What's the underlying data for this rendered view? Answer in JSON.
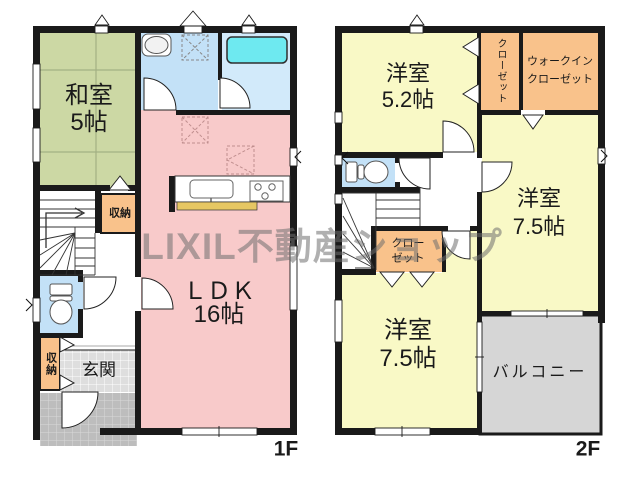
{
  "watermark": "LIXIL不動産ショップ",
  "floor1": {
    "label": "1F",
    "washitsu": {
      "name": "和室",
      "size": "5帖"
    },
    "ldk": {
      "name": "ＬＤＫ",
      "size": "16帖"
    },
    "stair_storage": {
      "name": "収納"
    },
    "entry_storage": {
      "name": "収納"
    },
    "genkan": {
      "name": "玄関"
    }
  },
  "floor2": {
    "label": "2F",
    "bedroom52": {
      "name": "洋室",
      "size": "5.2帖"
    },
    "bedroom75_right": {
      "name": "洋室",
      "size": "7.5帖"
    },
    "bedroom75_bottom": {
      "name": "洋室",
      "size": "7.5帖"
    },
    "closet_top": {
      "name": "クローゼット"
    },
    "walkin_closet": {
      "line1": "ウォークイン",
      "line2": "クローゼット"
    },
    "closet_mid": {
      "line1": "クロー",
      "line2": "ゼット"
    },
    "balcony": {
      "name": "バルコニー"
    }
  },
  "colors": {
    "tatami_green": "#ccd8a4",
    "washroom_blue": "#c3e1f7",
    "bathroom_blue": "#d2eafa",
    "tub_cyan": "#6ee9f0",
    "ldk_pink": "#f8caca",
    "bedroom_yellow": "#f9f9c6",
    "closet_orange": "#f9c28b",
    "toilet_blue": "#c3e1f7",
    "balcony_gray": "#d6d6d6",
    "genkan_tile": "#dedede",
    "porch_tile": "#bdbdbd",
    "counter_yellow": "#e6c763",
    "wall_black": "#1a1a1a"
  }
}
